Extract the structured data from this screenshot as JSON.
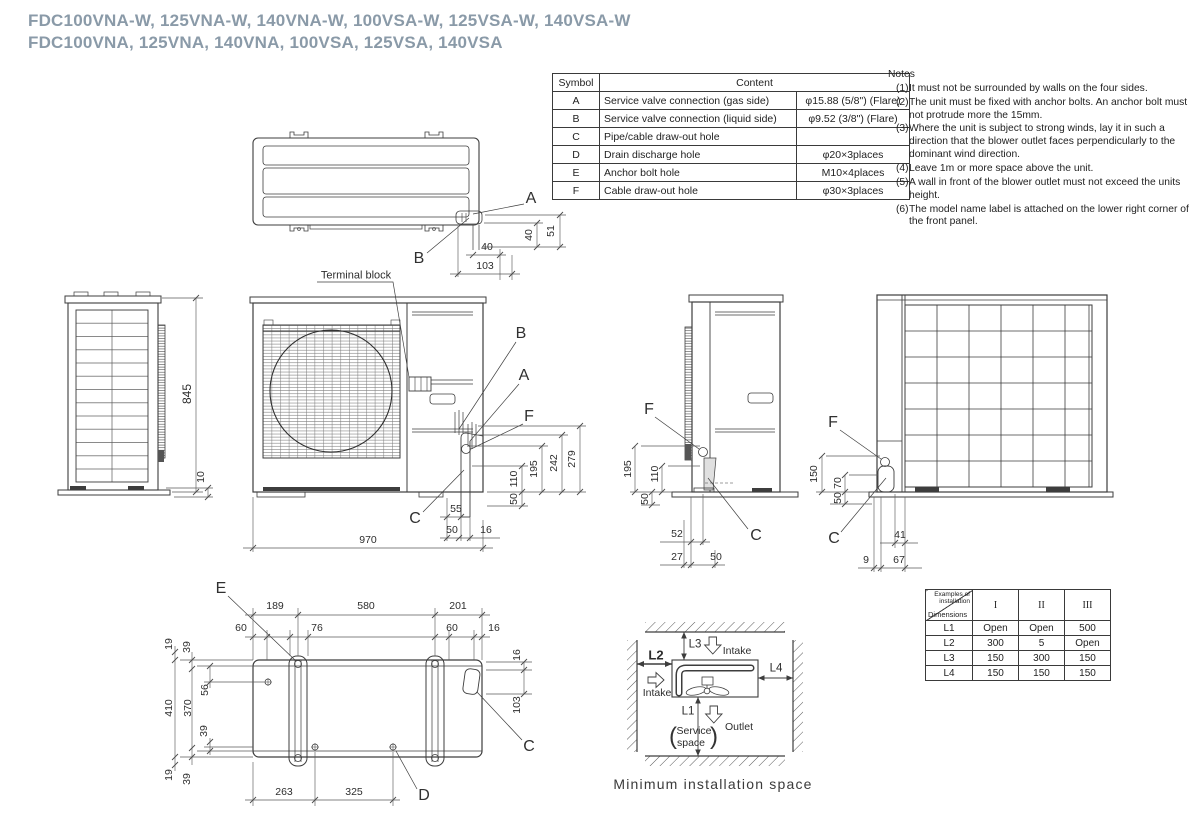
{
  "title": {
    "line1": "FDC100VNA-W, 125VNA-W, 140VNA-W, 100VSA-W, 125VSA-W, 140VSA-W",
    "line2": "FDC100VNA, 125VNA, 140VNA, 100VSA, 125VSA, 140VSA"
  },
  "symbol_table": {
    "header_symbol": "Symbol",
    "header_content": "Content",
    "rows": [
      {
        "symbol": "A",
        "content": "Service valve connection (gas side)",
        "spec": "φ15.88 (5/8\") (Flare)"
      },
      {
        "symbol": "B",
        "content": "Service valve connection (liquid side)",
        "spec": "φ9.52 (3/8\") (Flare)"
      },
      {
        "symbol": "C",
        "content": "Pipe/cable draw-out hole",
        "spec": ""
      },
      {
        "symbol": "D",
        "content": "Drain discharge hole",
        "spec": "φ20×3places"
      },
      {
        "symbol": "E",
        "content": "Anchor bolt hole",
        "spec": "M10×4places"
      },
      {
        "symbol": "F",
        "content": "Cable draw-out hole",
        "spec": "φ30×3places"
      }
    ]
  },
  "notes": {
    "heading": "Notes",
    "items": [
      {
        "num": "(1)",
        "text": "It must not be surrounded by walls on the four sides."
      },
      {
        "num": "(2)",
        "text": "The unit must be fixed with anchor bolts. An anchor bolt must not protrude more the 15mm."
      },
      {
        "num": "(3)",
        "text": "Where the unit is subject to strong winds, lay it in such a direction that the blower outlet faces perpendicularly to the dominant wind direction."
      },
      {
        "num": "(4)",
        "text": "Leave 1m or more space above the unit."
      },
      {
        "num": "(5)",
        "text": "A wall in front of the blower outlet must not exceed the units height."
      },
      {
        "num": "(6)",
        "text": "The model name label is attached on the lower right corner of the front panel."
      }
    ]
  },
  "views": {
    "top": {
      "callout_a": "A",
      "callout_b": "B",
      "dim_40h": "40",
      "dim_103": "103",
      "dim_40v": "40",
      "dim_51v": "51",
      "terminal_block": "Terminal block"
    },
    "side_left": {
      "dim_845": "845",
      "dim_10": "10"
    },
    "front": {
      "callout_b": "B",
      "callout_a": "A",
      "callout_f": "F",
      "callout_c": "C",
      "dim_110": "110",
      "dim_195": "195",
      "dim_242": "242",
      "dim_279": "279",
      "dim_50v": "50",
      "dim_55": "55",
      "dim_50b": "50",
      "dim_16": "16",
      "dim_970": "970"
    },
    "side_right": {
      "callout_f": "F",
      "callout_c": "C",
      "dim_195": "195",
      "dim_110": "110",
      "dim_50": "50",
      "dim_52": "52",
      "dim_27": "27",
      "dim_50b": "50"
    },
    "back": {
      "callout_f": "F",
      "callout_c": "C",
      "dim_150": "150",
      "dim_70": "70",
      "dim_50": "50",
      "dim_41": "41",
      "dim_9": "9",
      "dim_67": "67"
    },
    "bottom": {
      "callout_e": "E",
      "callout_d": "D",
      "callout_c": "C",
      "dim_189": "189",
      "dim_580": "580",
      "dim_201": "201",
      "dim_60a": "60",
      "dim_76": "76",
      "dim_60b": "60",
      "dim_16a": "16",
      "dim_19a": "19",
      "dim_39a": "39",
      "dim_410": "410",
      "dim_370": "370",
      "dim_56": "56",
      "dim_39b": "39",
      "dim_19b": "19",
      "dim_39c": "39",
      "dim_16b": "16",
      "dim_103": "103",
      "dim_263": "263",
      "dim_325": "325"
    }
  },
  "min_space": {
    "l1": "L1",
    "l2": "L2",
    "l3": "L3",
    "l4": "L4",
    "intake_left": "Intake",
    "intake_top": "Intake",
    "outlet": "Outlet",
    "service_open": "(",
    "service_line1": "Service",
    "service_line2": "space",
    "service_close": ")",
    "caption": "Minimum installation space"
  },
  "install_table": {
    "corner_top": "Examples of installation",
    "corner_bottom": "Dimensions",
    "columns": [
      "I",
      "II",
      "III"
    ],
    "rows": [
      {
        "dim": "L1",
        "values": [
          "Open",
          "Open",
          "500"
        ]
      },
      {
        "dim": "L2",
        "values": [
          "300",
          "5",
          "Open"
        ]
      },
      {
        "dim": "L3",
        "values": [
          "150",
          "300",
          "150"
        ]
      },
      {
        "dim": "L4",
        "values": [
          "150",
          "150",
          "150"
        ]
      }
    ]
  }
}
